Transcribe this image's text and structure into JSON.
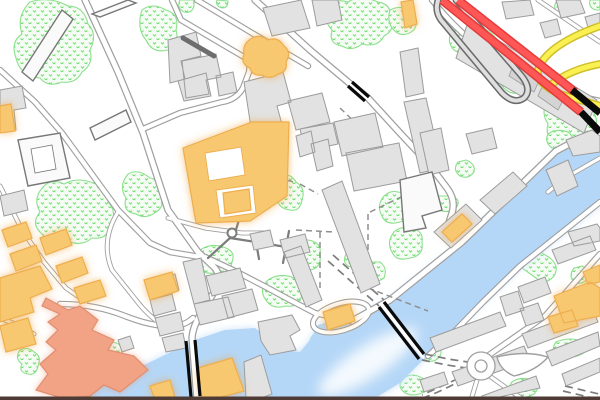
{
  "view": {
    "width": 600,
    "height": 400,
    "type": "city-map-tile",
    "visible_text": "none"
  },
  "colors": {
    "land": "#FFFFFF",
    "water": "#B5D7F7",
    "waterGlow": "#CCE3FB",
    "building": "#E2E2E2",
    "buildingStroke": "#9C9C9C",
    "buildingLight": "#FAFAFA",
    "buildingLightStroke": "#777777",
    "landmark": "#F8C871",
    "landmarkStroke": "#EDAE4F",
    "landmarkGlow": "#F0A030",
    "civic": "#F2A285",
    "civicStroke": "#E08F70",
    "park": "#F4FCF4",
    "parkDot": "#6FDC6F",
    "parkStroke": "#8CE08C",
    "roadFill": "#FFFFFF",
    "roadCasing": "#A0A0A0",
    "pathDark": "#7C7C7C",
    "pathDash": "#8F8F8F",
    "motorway": "#FF5656",
    "motorwayCasing": "#E23B3B",
    "highwayYellow": "#FBF052",
    "highwayYellowCasing": "#CDC02A",
    "bridge": "#0A0A0A",
    "loopCasing": "#6A6A6A",
    "loopFill": "#DFDFDF",
    "platform": "#6E6E6E",
    "bottomBar": "#4E3B35"
  },
  "legend": [
    {
      "feature": "water",
      "color": "#B5D7F7"
    },
    {
      "feature": "building",
      "color": "#E2E2E2"
    },
    {
      "feature": "landmark-building",
      "color": "#F8C871"
    },
    {
      "feature": "civic-building",
      "color": "#F2A285"
    },
    {
      "feature": "park-vegetation",
      "color": "#6FDC6F"
    },
    {
      "feature": "motorway",
      "color": "#FF5656"
    },
    {
      "feature": "secondary-highway",
      "color": "#FBF052"
    },
    {
      "feature": "bridge",
      "color": "#0A0A0A"
    }
  ],
  "counts": {
    "bridges": 4,
    "roundabouts": 1,
    "landmark-clusters": 6,
    "park-patches": 30
  }
}
